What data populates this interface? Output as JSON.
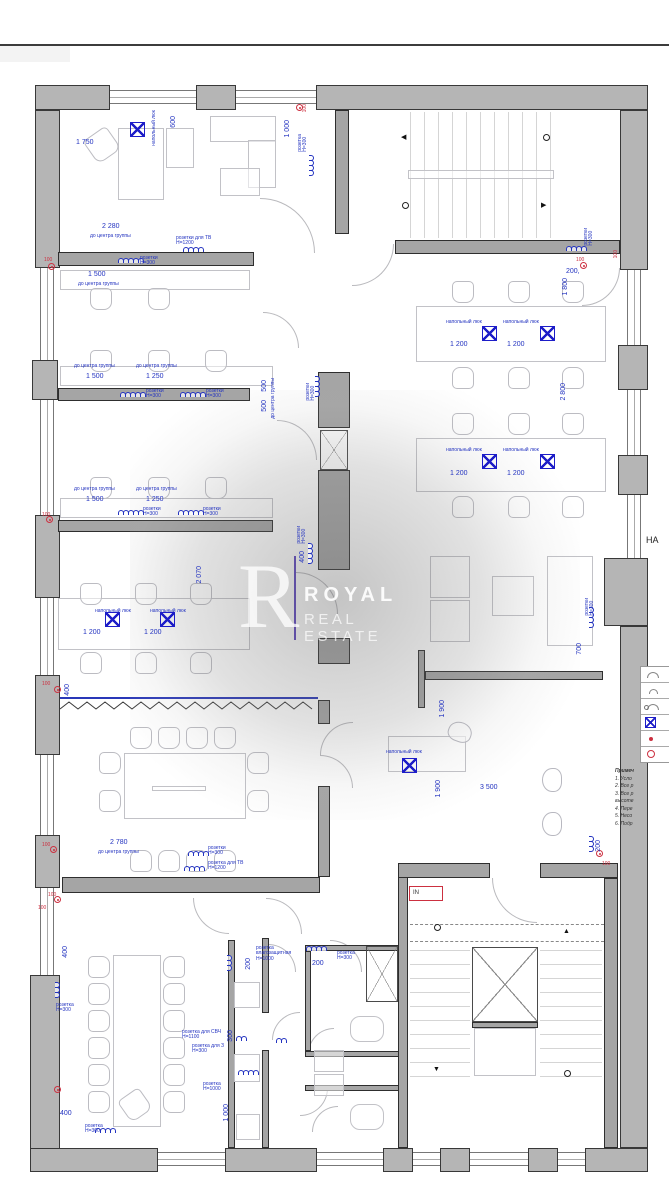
{
  "watermark": {
    "letter": "R",
    "line1": "ROYAL",
    "line2": "REAL ESTATE"
  },
  "right_panel": {
    "partial_title": "НА",
    "legend": {
      "rows": [
        {
          "icon": "socket-arc"
        },
        {
          "icon": "socket-arc-small"
        },
        {
          "icon": "socket-circle-arc"
        },
        {
          "icon": "floor-hatch"
        },
        {
          "icon": "red-dot"
        },
        {
          "icon": "red-circle"
        }
      ]
    },
    "notes_title": "Примеч",
    "notes": [
      "1. Усло",
      "2. Все р",
      "3. Все р",
      "высоте",
      "4. Пере",
      "5. Несо",
      "6. Подр"
    ]
  },
  "plan": {
    "entry_label": "IN",
    "annotations": [
      {
        "t": "1 750",
        "x": 76,
        "y": 139,
        "c": "dim"
      },
      {
        "t": "600",
        "x": 170,
        "y": 116,
        "c": "dim",
        "r": 1
      },
      {
        "t": "напольный люк",
        "x": 152,
        "y": 110,
        "c": "lbl",
        "r": 1
      },
      {
        "t": "1 000",
        "x": 284,
        "y": 120,
        "c": "dim",
        "r": 1
      },
      {
        "t": "розетка\nН=300",
        "x": 298,
        "y": 134,
        "c": "lbl",
        "r": 1
      },
      {
        "t": "100",
        "x": 303,
        "y": 104,
        "c": "red",
        "r": 1
      },
      {
        "t": "2 280",
        "x": 102,
        "y": 223,
        "c": "dim"
      },
      {
        "t": "до центра группы",
        "x": 90,
        "y": 234,
        "c": "lbl"
      },
      {
        "t": "розетки для ТВ\nН=1200",
        "x": 176,
        "y": 236,
        "c": "lbl"
      },
      {
        "t": "розетки\nН=300",
        "x": 140,
        "y": 256,
        "c": "lbl"
      },
      {
        "t": "1 500",
        "x": 88,
        "y": 271,
        "c": "dim"
      },
      {
        "t": "до центра группы",
        "x": 78,
        "y": 282,
        "c": "lbl"
      },
      {
        "t": "100",
        "x": 44,
        "y": 258,
        "c": "red"
      },
      {
        "t": "до центра группы",
        "x": 74,
        "y": 364,
        "c": "lbl"
      },
      {
        "t": "до центра группы",
        "x": 136,
        "y": 364,
        "c": "lbl"
      },
      {
        "t": "1 500",
        "x": 86,
        "y": 373,
        "c": "dim"
      },
      {
        "t": "1 250",
        "x": 146,
        "y": 373,
        "c": "dim"
      },
      {
        "t": "розетки\nН=300",
        "x": 146,
        "y": 389,
        "c": "lbl"
      },
      {
        "t": "розетки\nН=300",
        "x": 206,
        "y": 389,
        "c": "lbl"
      },
      {
        "t": "до центра группы",
        "x": 271,
        "y": 378,
        "c": "lbl",
        "r": 1
      },
      {
        "t": "500",
        "x": 261,
        "y": 380,
        "c": "dim",
        "r": 1
      },
      {
        "t": "500",
        "x": 261,
        "y": 400,
        "c": "dim",
        "r": 1
      },
      {
        "t": "розетки\nН=300",
        "x": 306,
        "y": 383,
        "c": "lbl",
        "r": 1
      },
      {
        "t": "до центра группы",
        "x": 74,
        "y": 487,
        "c": "lbl"
      },
      {
        "t": "до центра группы",
        "x": 136,
        "y": 487,
        "c": "lbl"
      },
      {
        "t": "1 500",
        "x": 86,
        "y": 496,
        "c": "dim"
      },
      {
        "t": "1 250",
        "x": 146,
        "y": 496,
        "c": "dim"
      },
      {
        "t": "розетки\nН=300",
        "x": 143,
        "y": 507,
        "c": "lbl"
      },
      {
        "t": "розетки\nН=300",
        "x": 203,
        "y": 507,
        "c": "lbl"
      },
      {
        "t": "100",
        "x": 42,
        "y": 513,
        "c": "red"
      },
      {
        "t": "2 070",
        "x": 196,
        "y": 566,
        "c": "dim",
        "r": 1
      },
      {
        "t": "розетки\nН=300",
        "x": 297,
        "y": 526,
        "c": "lbl",
        "r": 1
      },
      {
        "t": "400",
        "x": 299,
        "y": 551,
        "c": "dim",
        "r": 1
      },
      {
        "t": "напольный люк",
        "x": 95,
        "y": 609,
        "c": "lbl"
      },
      {
        "t": "напольный люк",
        "x": 150,
        "y": 609,
        "c": "lbl"
      },
      {
        "t": "1 200",
        "x": 83,
        "y": 629,
        "c": "dim"
      },
      {
        "t": "1 200",
        "x": 144,
        "y": 629,
        "c": "dim"
      },
      {
        "t": "100",
        "x": 42,
        "y": 682,
        "c": "red"
      },
      {
        "t": "400",
        "x": 64,
        "y": 684,
        "c": "dim",
        "r": 1
      },
      {
        "t": "2 780",
        "x": 110,
        "y": 839,
        "c": "dim"
      },
      {
        "t": "до центра группы",
        "x": 98,
        "y": 850,
        "c": "lbl"
      },
      {
        "t": "розетки\nН=300",
        "x": 208,
        "y": 846,
        "c": "lbl"
      },
      {
        "t": "розетка для ТВ\nН=1200",
        "x": 208,
        "y": 861,
        "c": "lbl"
      },
      {
        "t": "100",
        "x": 42,
        "y": 843,
        "c": "red"
      },
      {
        "t": "100",
        "x": 48,
        "y": 893,
        "c": "red"
      },
      {
        "t": "400",
        "x": 62,
        "y": 946,
        "c": "dim",
        "r": 1
      },
      {
        "t": "розетка\nН=300",
        "x": 56,
        "y": 1003,
        "c": "lbl"
      },
      {
        "t": "400",
        "x": 60,
        "y": 1110,
        "c": "dim"
      },
      {
        "t": "розетка\nН=300",
        "x": 85,
        "y": 1124,
        "c": "lbl"
      },
      {
        "t": "100",
        "x": 38,
        "y": 906,
        "c": "red"
      },
      {
        "t": "розетка\nвлагозащитная\nН=1000",
        "x": 256,
        "y": 946,
        "c": "lbl"
      },
      {
        "t": "200",
        "x": 245,
        "y": 958,
        "c": "dim",
        "r": 1
      },
      {
        "t": "розетка\nН=300",
        "x": 337,
        "y": 951,
        "c": "lbl"
      },
      {
        "t": "200",
        "x": 312,
        "y": 960,
        "c": "dim"
      },
      {
        "t": "розетка для СВЧ\nН=1100",
        "x": 182,
        "y": 1030,
        "c": "lbl"
      },
      {
        "t": "розетка для З\nН=300",
        "x": 192,
        "y": 1044,
        "c": "lbl"
      },
      {
        "t": "300",
        "x": 227,
        "y": 1030,
        "c": "dim",
        "r": 1
      },
      {
        "t": "розетка\nН=1000",
        "x": 203,
        "y": 1082,
        "c": "lbl"
      },
      {
        "t": "1 000",
        "x": 223,
        "y": 1104,
        "c": "dim",
        "r": 1
      },
      {
        "t": "розетки\nН=300",
        "x": 584,
        "y": 228,
        "c": "lbl",
        "r": 1
      },
      {
        "t": "100",
        "x": 576,
        "y": 258,
        "c": "red"
      },
      {
        "t": "100",
        "x": 614,
        "y": 250,
        "c": "red",
        "r": 1
      },
      {
        "t": "200,",
        "x": 566,
        "y": 268,
        "c": "dim"
      },
      {
        "t": "1 800",
        "x": 562,
        "y": 278,
        "c": "dim",
        "r": 1
      },
      {
        "t": "напольный люк",
        "x": 446,
        "y": 320,
        "c": "lbl"
      },
      {
        "t": "напольный люк",
        "x": 503,
        "y": 320,
        "c": "lbl"
      },
      {
        "t": "1 200",
        "x": 450,
        "y": 341,
        "c": "dim"
      },
      {
        "t": "1 200",
        "x": 507,
        "y": 341,
        "c": "dim"
      },
      {
        "t": "2 800",
        "x": 560,
        "y": 383,
        "c": "dim",
        "r": 1
      },
      {
        "t": "напольный люк",
        "x": 446,
        "y": 448,
        "c": "lbl"
      },
      {
        "t": "напольный люк",
        "x": 503,
        "y": 448,
        "c": "lbl"
      },
      {
        "t": "1 200",
        "x": 450,
        "y": 470,
        "c": "dim"
      },
      {
        "t": "1 200",
        "x": 507,
        "y": 470,
        "c": "dim"
      },
      {
        "t": "розетки\nН=300",
        "x": 585,
        "y": 598,
        "c": "lbl",
        "r": 1
      },
      {
        "t": "700",
        "x": 576,
        "y": 643,
        "c": "dim",
        "r": 1
      },
      {
        "t": "1 900",
        "x": 439,
        "y": 700,
        "c": "dim",
        "r": 1
      },
      {
        "t": "напольный люк",
        "x": 386,
        "y": 750,
        "c": "lbl"
      },
      {
        "t": "3 500",
        "x": 480,
        "y": 784,
        "c": "dim"
      },
      {
        "t": "1 900",
        "x": 435,
        "y": 780,
        "c": "dim",
        "r": 1
      },
      {
        "t": "200",
        "x": 595,
        "y": 840,
        "c": "dim",
        "r": 1
      },
      {
        "t": "100",
        "x": 602,
        "y": 862,
        "c": "red"
      },
      {
        "t": "НА",
        "x": 646,
        "y": 536,
        "c": "blk"
      }
    ],
    "socket_groups": [
      {
        "x": 118,
        "y": 258,
        "n": 5
      },
      {
        "x": 183,
        "y": 247,
        "n": 4
      },
      {
        "x": 120,
        "y": 392,
        "n": 5
      },
      {
        "x": 180,
        "y": 392,
        "n": 5
      },
      {
        "x": 118,
        "y": 510,
        "n": 5
      },
      {
        "x": 178,
        "y": 510,
        "n": 5
      },
      {
        "x": 320,
        "y": 376,
        "n": 4,
        "r": 1
      },
      {
        "x": 313,
        "y": 543,
        "n": 4,
        "r": 1
      },
      {
        "x": 188,
        "y": 851,
        "n": 4
      },
      {
        "x": 184,
        "y": 866,
        "n": 4
      },
      {
        "x": 314,
        "y": 155,
        "n": 4,
        "r": 1
      },
      {
        "x": 566,
        "y": 246,
        "n": 4
      },
      {
        "x": 594,
        "y": 607,
        "n": 4,
        "r": 1
      },
      {
        "x": 594,
        "y": 836,
        "n": 3,
        "r": 1
      },
      {
        "x": 60,
        "y": 982,
        "n": 3,
        "r": 1
      },
      {
        "x": 95,
        "y": 1128,
        "n": 4
      },
      {
        "x": 236,
        "y": 1036,
        "n": 2
      },
      {
        "x": 238,
        "y": 1070,
        "n": 4
      },
      {
        "x": 276,
        "y": 1038,
        "n": 2
      },
      {
        "x": 306,
        "y": 946,
        "n": 4
      },
      {
        "x": 232,
        "y": 955,
        "n": 3,
        "r": 1
      }
    ],
    "floor_hatches": [
      {
        "x": 130,
        "y": 122
      },
      {
        "x": 482,
        "y": 326
      },
      {
        "x": 540,
        "y": 326
      },
      {
        "x": 482,
        "y": 454
      },
      {
        "x": 540,
        "y": 454
      },
      {
        "x": 105,
        "y": 612
      },
      {
        "x": 160,
        "y": 612
      },
      {
        "x": 402,
        "y": 758
      }
    ],
    "red_sockets": [
      {
        "x": 48,
        "y": 263
      },
      {
        "x": 46,
        "y": 516
      },
      {
        "x": 54,
        "y": 686
      },
      {
        "x": 50,
        "y": 846
      },
      {
        "x": 54,
        "y": 896
      },
      {
        "x": 580,
        "y": 262
      },
      {
        "x": 596,
        "y": 850
      },
      {
        "x": 296,
        "y": 104
      },
      {
        "x": 54,
        "y": 1086
      }
    ],
    "nav_icons": [
      {
        "g": "◀",
        "x": 401,
        "y": 134
      },
      {
        "g": "○",
        "x": 543,
        "y": 134
      },
      {
        "g": "○",
        "x": 402,
        "y": 202
      },
      {
        "g": "▶",
        "x": 541,
        "y": 202
      },
      {
        "g": "○",
        "x": 434,
        "y": 924
      },
      {
        "g": "▲",
        "x": 563,
        "y": 928
      },
      {
        "g": "▼",
        "x": 433,
        "y": 1066
      },
      {
        "g": "○",
        "x": 564,
        "y": 1070
      }
    ]
  },
  "colors": {
    "wall": "#b5b5b5",
    "wall_outline": "#383838",
    "annotation_blue": "#2333c0",
    "annotation_red": "#cc3040",
    "hatch_blue": "#1d1dc8",
    "watermark": "#ffffff"
  }
}
